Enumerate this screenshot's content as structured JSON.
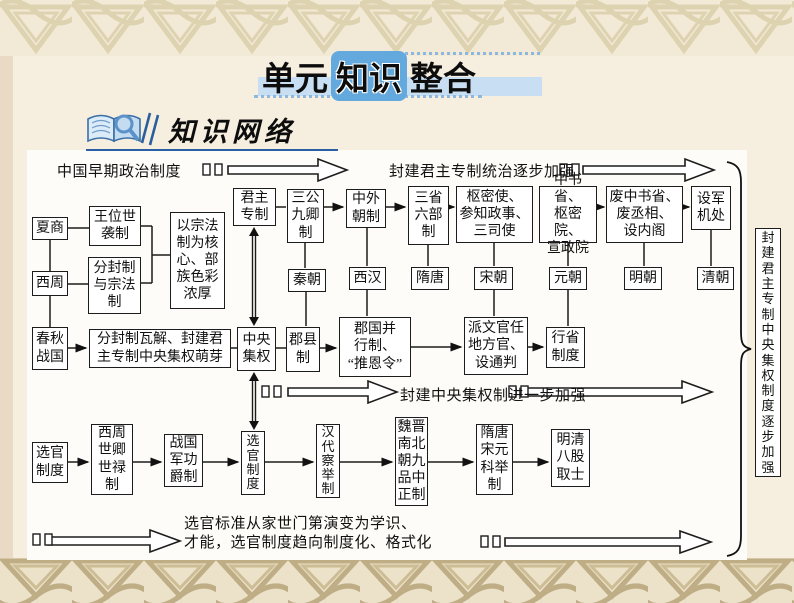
{
  "page_title": {
    "segments": [
      "单元",
      "知识",
      "整合"
    ]
  },
  "section": {
    "title": "知识网络",
    "icon": "book-with-magnifier-icon"
  },
  "colors": {
    "accent_blue": "#64a9dd",
    "band_blue": "#c8def2",
    "underline_blue": "#2a5fa5",
    "border_tan_top": "#d9cda8",
    "border_tan_bottom": "#bfae85"
  },
  "diagram": {
    "flow_labels": {
      "early": "中国早期政治制度",
      "monarchy": "封建君主专制统治逐步加强",
      "centralization": "封建中央集权制进一步加强",
      "selection": "选官标准从家世门第演变为学识、\n才能，选官制度趋向制度化、格式化",
      "side_summary": "封建君主专制中央集权制度逐步加强"
    },
    "boxes": {
      "xia_shang": "夏商",
      "wangwei": "王位世\n袭制",
      "xizhou": "西周",
      "fenfeng": "分封制\n与宗法\n制",
      "zongfa": "以宗法\n制为核\n心、部\n族色彩\n浓厚",
      "chunqiu": "春秋\n战国",
      "mengya": "分封制瓦解、封建君\n主专制中央集权萌芽",
      "junzhu": "君主\n专制",
      "sangong": "三公\n九卿\n制",
      "zhongwai": "中外\n朝制",
      "sansheng": "三省\n六部\n制",
      "shumi": "枢密使、\n参知政事、\n三司使",
      "zhongshu": "中书省、\n枢密院、\n宣政院",
      "feizhong": "废中书省、\n废丞相、\n设内阁",
      "shejun": "设军\n机处",
      "qin": "秦朝",
      "xihan": "西汉",
      "suitang": "隋唐",
      "song": "宋朝",
      "yuan": "元朝",
      "ming": "明朝",
      "qing": "清朝",
      "zhongyang": "中央\n集权",
      "junxian": "郡县\n制",
      "junguo": "郡国并\n行制、\n“推恩令”",
      "paiwen": "派文官任\n地方官、\n设通判",
      "xingsheng": "行省\n制度",
      "xuanguan": "选官\n制度",
      "shiqing": "西周\n世卿\n世禄\n制",
      "zhanguo": "战国\n军功\n爵制",
      "xuanguan_v": "选\n官\n制\n度",
      "handai": "汉\n代\n察\n举\n制",
      "weijin": "魏晋\n南北\n朝九\n品中\n正制",
      "keju": "隋唐\n宋元\n科举\n制",
      "bagu": "明清\n八股\n取士"
    }
  }
}
